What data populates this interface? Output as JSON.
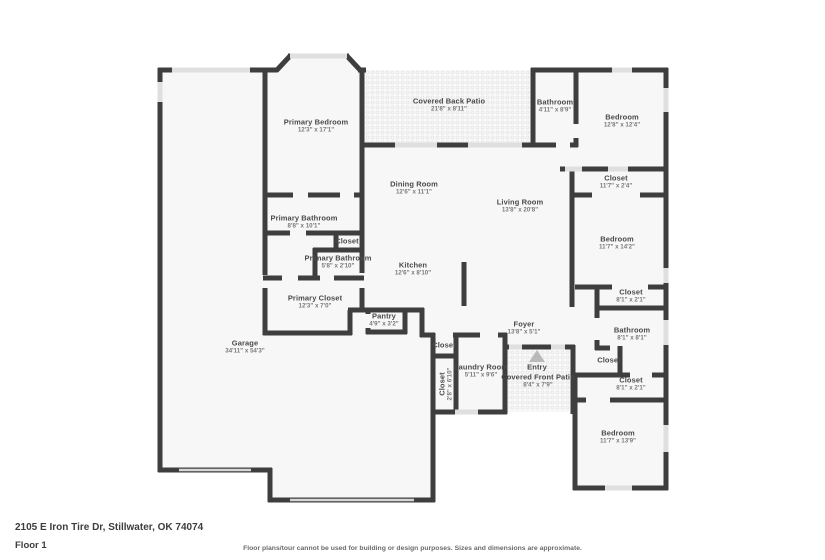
{
  "footer": {
    "address": "2105 E Iron Tire Dr, Stillwater, OK 74074",
    "floor_label": "Floor 1",
    "disclaimer": "Floor plans/tour cannot be used for building or design purposes. Sizes and dimensions are approximate."
  },
  "colors": {
    "wall": "#3e3e3e",
    "floor": "#f7f7f7",
    "window": "#dfdfdf",
    "garage_door": "#d6d6d6",
    "label": "#4a4a4a",
    "dim": "#7a7a7a",
    "patio_dot": "#e4e4e4",
    "patio_bg": "#f9f9f9",
    "entry_arrow": "#b9b9b9"
  },
  "floorplan": {
    "rooms": [
      {
        "name": "Primary Bedroom",
        "dims": "12'3\" x 17'1\"",
        "x": 316,
        "y": 126
      },
      {
        "name": "Covered Back Patio",
        "dims": "21'8\" x 8'11\"",
        "x": 449,
        "y": 105
      },
      {
        "name": "Bathroom",
        "dims": "4'11\" x 8'9\"",
        "x": 555,
        "y": 106
      },
      {
        "name": "Bedroom",
        "dims": "12'8\" x 12'4\"",
        "x": 622,
        "y": 121
      },
      {
        "name": "Closet",
        "dims": "11'7\" x 2'4\"",
        "x": 616,
        "y": 182
      },
      {
        "name": "Dining Room",
        "dims": "12'6\" x 11'1\"",
        "x": 414,
        "y": 188
      },
      {
        "name": "Living Room",
        "dims": "13'8\" x 20'8\"",
        "x": 520,
        "y": 206
      },
      {
        "name": "Primary Bathroom",
        "dims": "8'8\" x 10'1\"",
        "x": 304,
        "y": 222
      },
      {
        "name": "Closet",
        "dims": "",
        "x": 347,
        "y": 241
      },
      {
        "name": "Primary Bathroom",
        "dims": "5'8\" x 2'10\"",
        "x": 338,
        "y": 262
      },
      {
        "name": "Bedroom",
        "dims": "11'7\" x 14'2\"",
        "x": 617,
        "y": 243
      },
      {
        "name": "Kitchen",
        "dims": "12'6\" x 8'10\"",
        "x": 413,
        "y": 269
      },
      {
        "name": "Closet",
        "dims": "8'1\" x 2'1\"",
        "x": 631,
        "y": 296
      },
      {
        "name": "Primary Closet",
        "dims": "12'3\" x 7'0\"",
        "x": 315,
        "y": 302
      },
      {
        "name": "Pantry",
        "dims": "4'9\" x 3'2\"",
        "x": 384,
        "y": 320
      },
      {
        "name": "Foyer",
        "dims": "13'8\" x 5'1\"",
        "x": 524,
        "y": 328
      },
      {
        "name": "Bathroom",
        "dims": "8'1\" x 8'1\"",
        "x": 632,
        "y": 334
      },
      {
        "name": "Closet",
        "dims": "",
        "x": 444,
        "y": 345
      },
      {
        "name": "Garage",
        "dims": "34'11\" x 54'3\"",
        "x": 245,
        "y": 347
      },
      {
        "name": "Closet",
        "dims": "",
        "x": 609,
        "y": 360
      },
      {
        "name": "Entry",
        "dims": "",
        "x": 537,
        "y": 367
      },
      {
        "name": "Laundry Room",
        "dims": "5'11\" x 9'6\"",
        "x": 481,
        "y": 371
      },
      {
        "name": "Covered Front Patio",
        "dims": "8'4\" x 7'9\"",
        "x": 538,
        "y": 381
      },
      {
        "name": "Closet",
        "dims": "2'8\" x 6'10\"",
        "x": 446,
        "y": 384,
        "rotate": true
      },
      {
        "name": "Closet",
        "dims": "8'1\" x 2'1\"",
        "x": 631,
        "y": 384
      },
      {
        "name": "Bedroom",
        "dims": "11'7\" x 13'9\"",
        "x": 618,
        "y": 437
      }
    ]
  }
}
